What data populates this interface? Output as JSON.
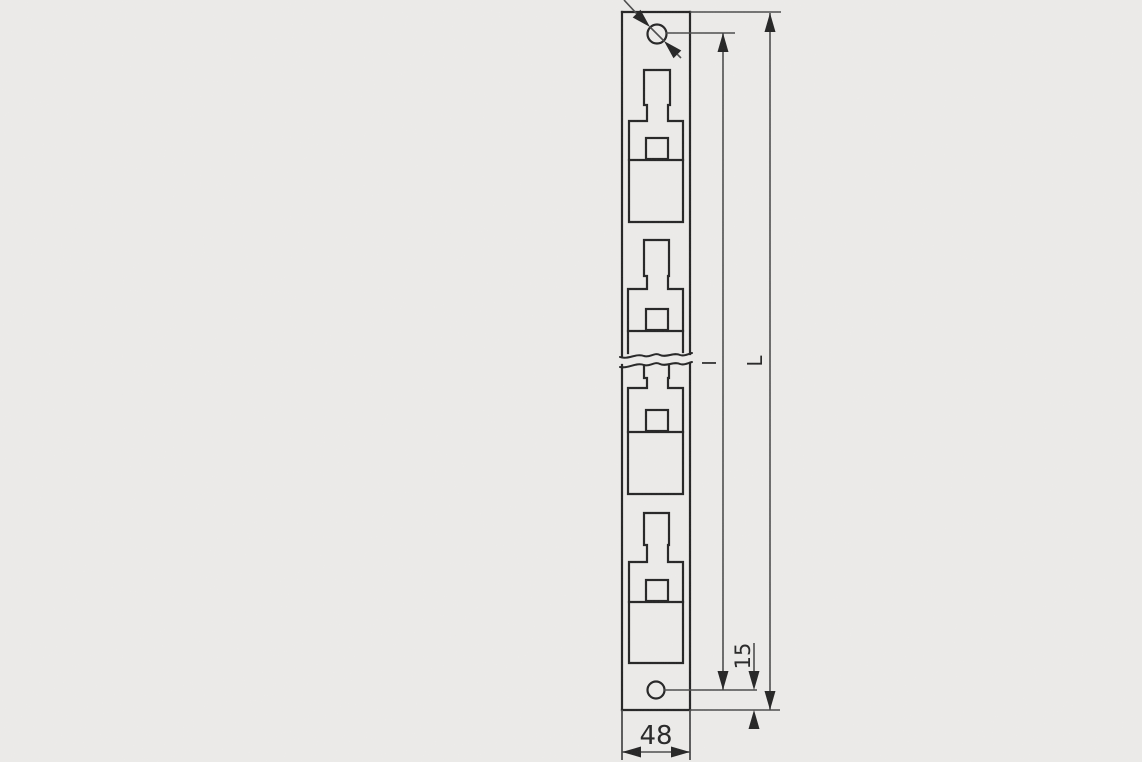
{
  "page": {
    "background": "#ebeae8"
  },
  "drawing": {
    "labels": {
      "width": "48",
      "edge_distance": "15",
      "hole_spacing": "l",
      "total_length": "L"
    },
    "colors": {
      "object_line": "#242424",
      "dim_line": "#4a4a4a",
      "text": "#262626"
    }
  }
}
